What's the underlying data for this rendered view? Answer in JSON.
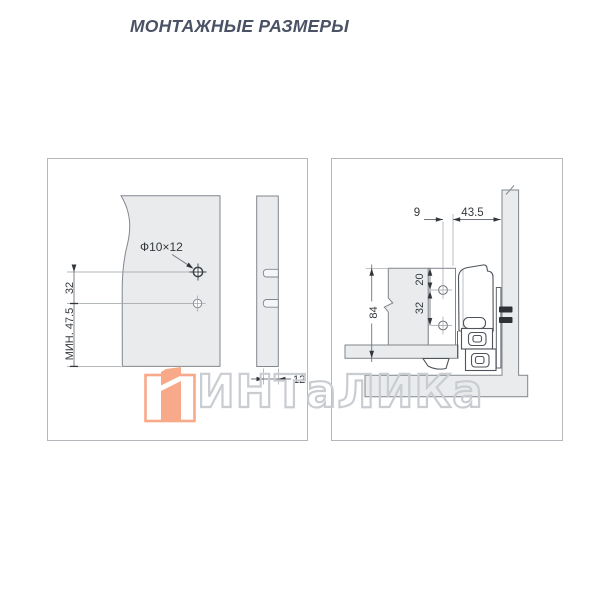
{
  "title": "МОНТАЖНЫЕ РАЗМЕРЫ",
  "watermark": {
    "brand": "ИНТаЛИКа",
    "logo_color": "#f8a98a",
    "outline_color": "#c9cdd2"
  },
  "left_view": {
    "hole_label": "Ф10×12",
    "dim_hole_spacing": "32",
    "dim_min_height": "МИН. 47.5",
    "dim_hole_depth": "12"
  },
  "right_view": {
    "dim_hole_to_front": "9",
    "dim_hole_to_side": "43.5",
    "dim_top_to_hole": "20",
    "dim_hole_spacing": "32",
    "dim_back_height": "84"
  },
  "colors": {
    "title_text": "#4a5266",
    "dimension_text": "#33373c",
    "panel_fill": "#e9ebec",
    "panel_outline": "#82878d",
    "profile_outline": "#4e545b",
    "frame_border": "#b4b8bd",
    "logo_accent": "#f8a98a",
    "watermark_outline": "#c9cdd2"
  }
}
